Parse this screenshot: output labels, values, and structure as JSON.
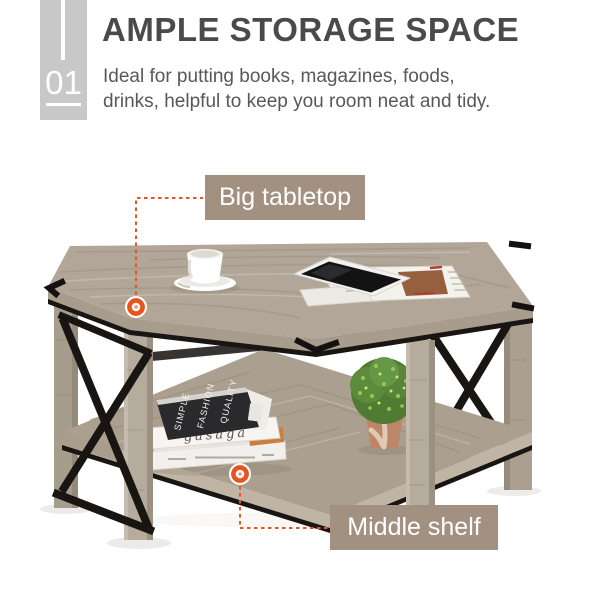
{
  "header": {
    "number": "01",
    "title": "AMPLE STORAGE SPACE",
    "description": "Ideal for putting books, magazines, foods, drinks, helpful to keep you room neat and tidy."
  },
  "callouts": [
    {
      "id": "tabletop",
      "label": "Big tabletop"
    },
    {
      "id": "shelf",
      "label": "Middle shelf"
    }
  ],
  "photo": {
    "subject": "rustic wood coffee table with black metal X-frame, top items: coffee cup on saucer, tablet on newspaper; shelf items: stack of books, green topiary plant in pot",
    "books": {
      "top_cover_words": [
        "SIMPLE",
        "FASHION",
        "QUALITY"
      ],
      "script_word": "gasaga"
    }
  },
  "colors": {
    "accent_orange": "#e8541d",
    "label_taupe": "#a29180",
    "badge_gray": "#c8c8c8",
    "title_gray": "#4a4a4a",
    "body_gray": "#585858",
    "wood": "#b1a697",
    "metal": "#181512"
  }
}
